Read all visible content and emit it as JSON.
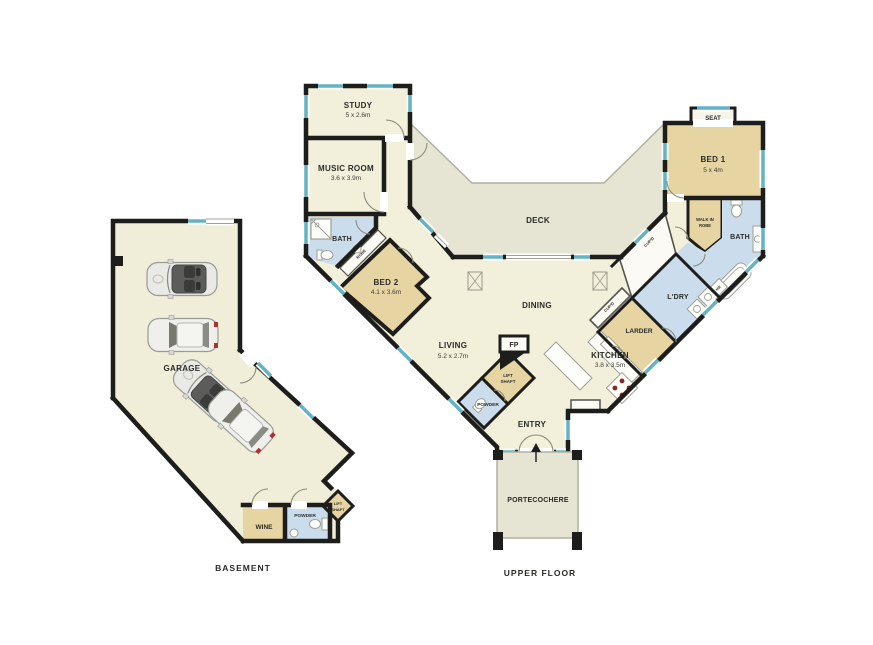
{
  "colors": {
    "wall": "#1d1d1b",
    "floor_cream": "#f2efda",
    "room_tan": "#e6d5a2",
    "room_blue": "#cbdded",
    "deck_gray": "#e6e4d2",
    "window_teal": "#64b3c4",
    "door_arc": "#8b8b7d",
    "stove_dot_red": "#8c2525",
    "taillight_red": "#b03030"
  },
  "upper_floor": {
    "caption": "UPPER FLOOR",
    "rooms": {
      "study": {
        "label": "STUDY",
        "dims": "5 x 2.6m"
      },
      "music_room": {
        "label": "MUSIC ROOM",
        "dims": "3.6 x 3.9m"
      },
      "bath_left": {
        "label": "BATH"
      },
      "robe": {
        "label": "ROBE"
      },
      "bed2": {
        "label": "BED 2",
        "dims": "4.1 x 3.6m"
      },
      "deck": {
        "label": "DECK"
      },
      "dining": {
        "label": "DINING"
      },
      "living": {
        "label": "LIVING",
        "dims": "5.2 x 2.7m"
      },
      "fireplace": {
        "label": "FP"
      },
      "lift_shaft": {
        "label_line1": "LIFT",
        "label_line2": "SHAFT"
      },
      "powder": {
        "label": "POWDER"
      },
      "entry": {
        "label": "ENTRY"
      },
      "kitchen": {
        "label": "KITCHEN",
        "dims": "3.8 x 3.5m"
      },
      "larder": {
        "label": "LARDER"
      },
      "laundry": {
        "label": "L'DRY"
      },
      "cupboard_top": {
        "label": "CUP'D"
      },
      "cupboard_bottom": {
        "label": "CUP'D"
      },
      "hot_water": {
        "label": "HW"
      },
      "walk_in_robe": {
        "label_line1": "WALK IN",
        "label_line2": "ROBE"
      },
      "bath_right": {
        "label": "BATH"
      },
      "bed1": {
        "label": "BED 1",
        "dims": "5 x 4m"
      },
      "seat": {
        "label": "SEAT"
      },
      "portecochere": {
        "label": "PORTECOCHERE"
      }
    }
  },
  "basement": {
    "caption": "BASEMENT",
    "rooms": {
      "garage": {
        "label": "GARAGE"
      },
      "wine": {
        "label": "WINE"
      },
      "powder": {
        "label": "POWDER"
      },
      "lift_shaft": {
        "label_line1": "LIFT",
        "label_line2": "SHAFT"
      }
    }
  }
}
